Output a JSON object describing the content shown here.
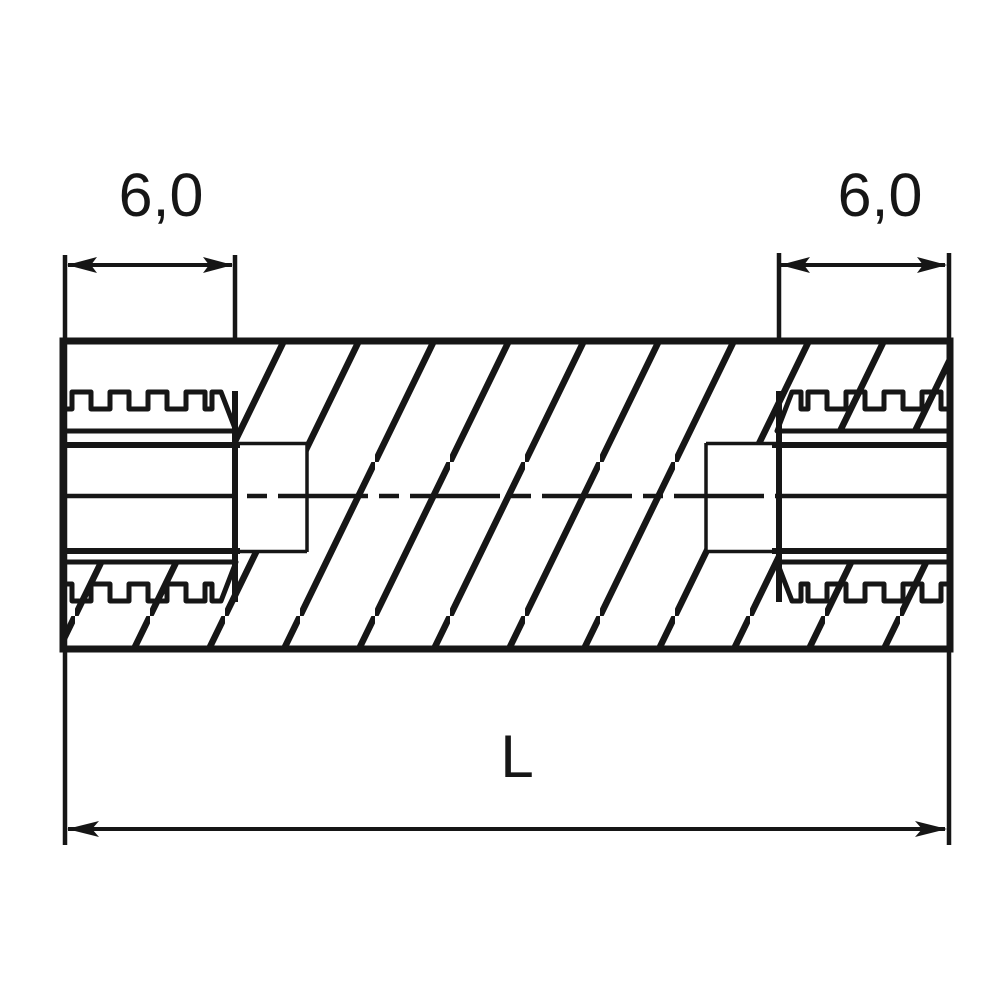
{
  "drawing": {
    "kind": "engineering-cross-section",
    "subject": "cylindrical spacer with internal threads at both ends",
    "colors": {
      "line": "#161616",
      "background": "#ffffff"
    },
    "labels": {
      "left_thread_depth": "6,0",
      "right_thread_depth": "6,0",
      "overall_length": "L"
    }
  }
}
